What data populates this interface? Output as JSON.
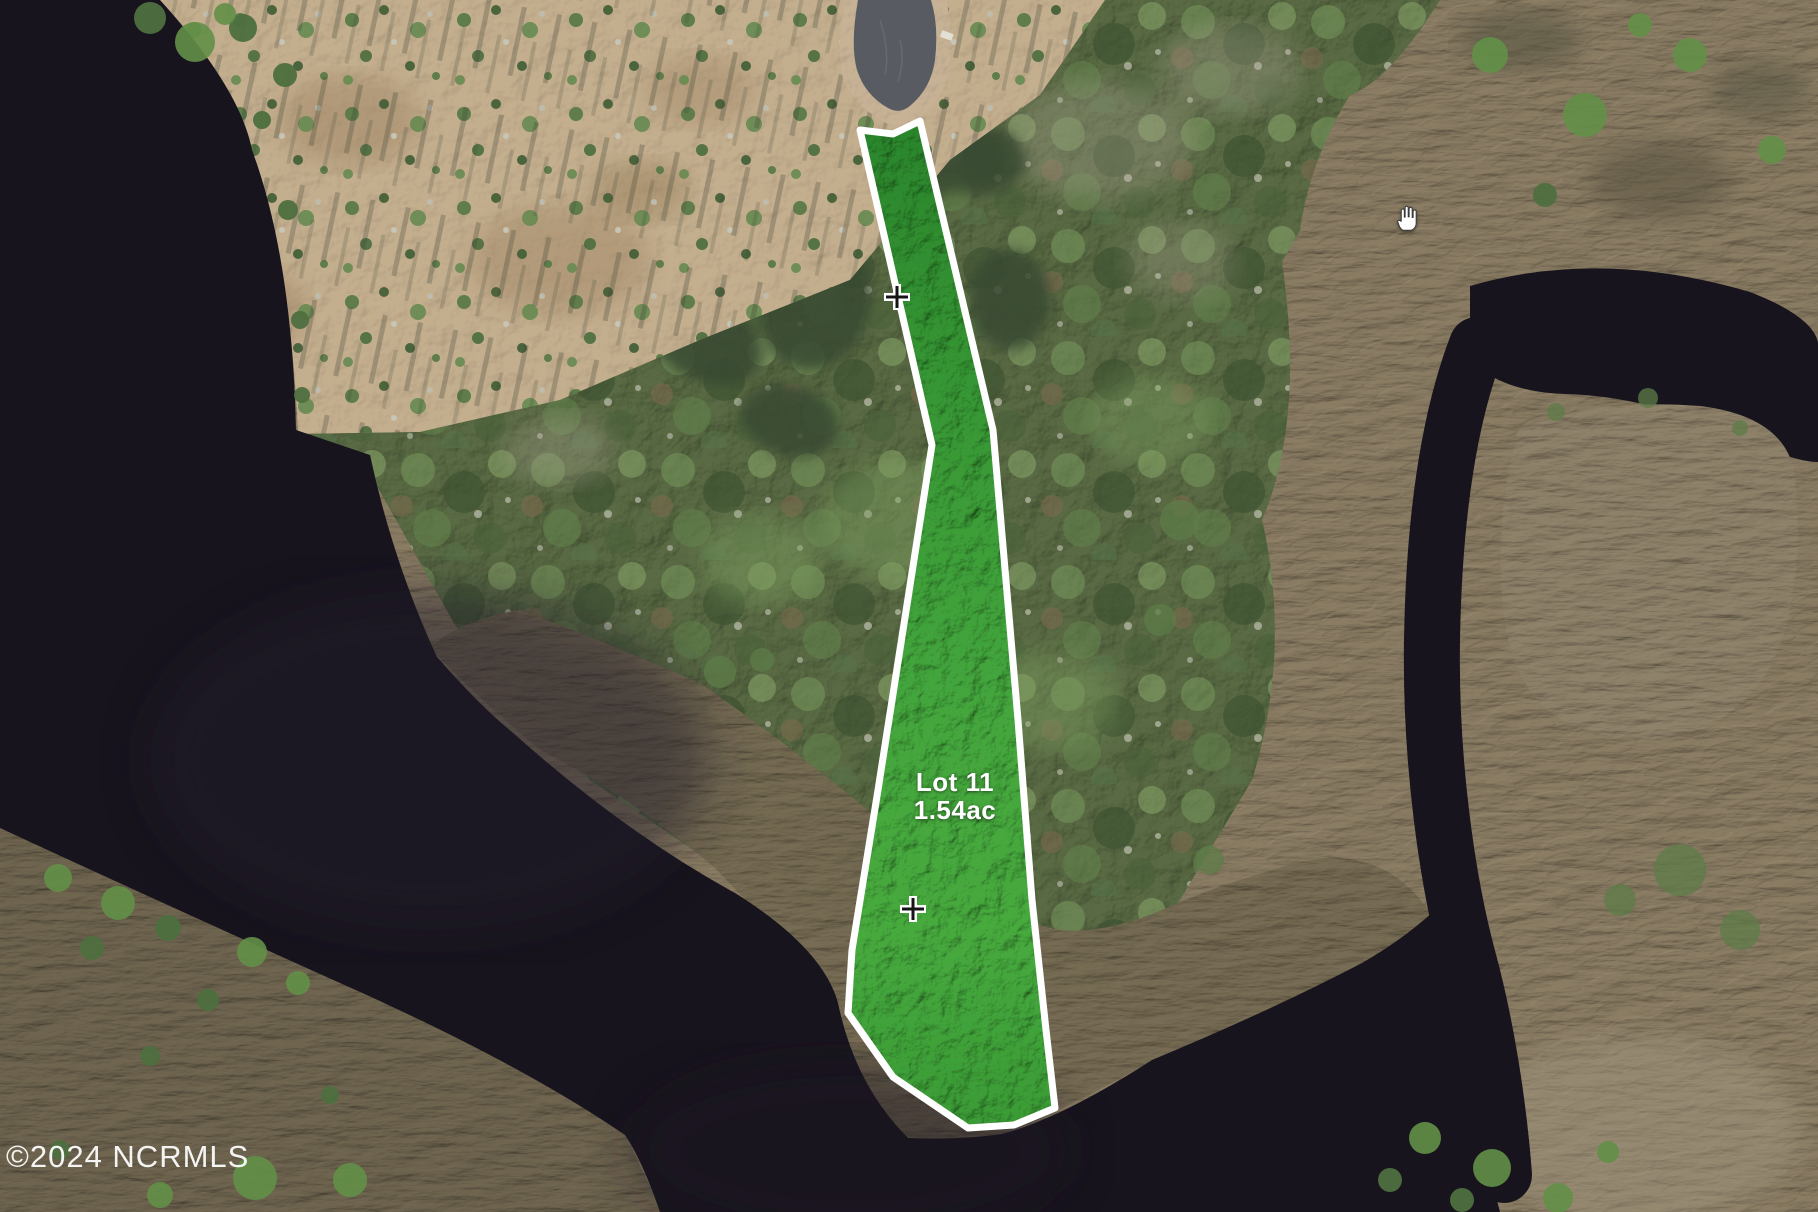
{
  "map": {
    "type": "aerial-parcel-photo",
    "lot": {
      "label_line1": "Lot 11",
      "label_line2": "1.54ac",
      "polygon_points": "860,130 893,134 920,121 993,430 1018,720 1032,900 1046,1030 1055,1108 1014,1125 968,1128 893,1077 848,1013 852,950 878,790 932,445",
      "outline_color": "#ffffff",
      "fill_color": "#3f9e38"
    },
    "markers": {
      "m1": {
        "transform": "translate(897,297)"
      },
      "m2": {
        "transform": "translate(913,909)"
      }
    },
    "cursor": {
      "type": "hand-grab",
      "style": "left:1396px;top:204px"
    },
    "watermark": {
      "text": "©2024 NCRMLS",
      "color": "#ffffff"
    },
    "colors": {
      "water": "#17141d",
      "marsh": "#8b7d64",
      "field": "#c3ae8e",
      "forest": "#5a6b44",
      "road_asphalt": "#585b62",
      "road_dirt": "#c7b295",
      "lot_green": "#3f9e38",
      "outline_white": "#ffffff"
    }
  }
}
